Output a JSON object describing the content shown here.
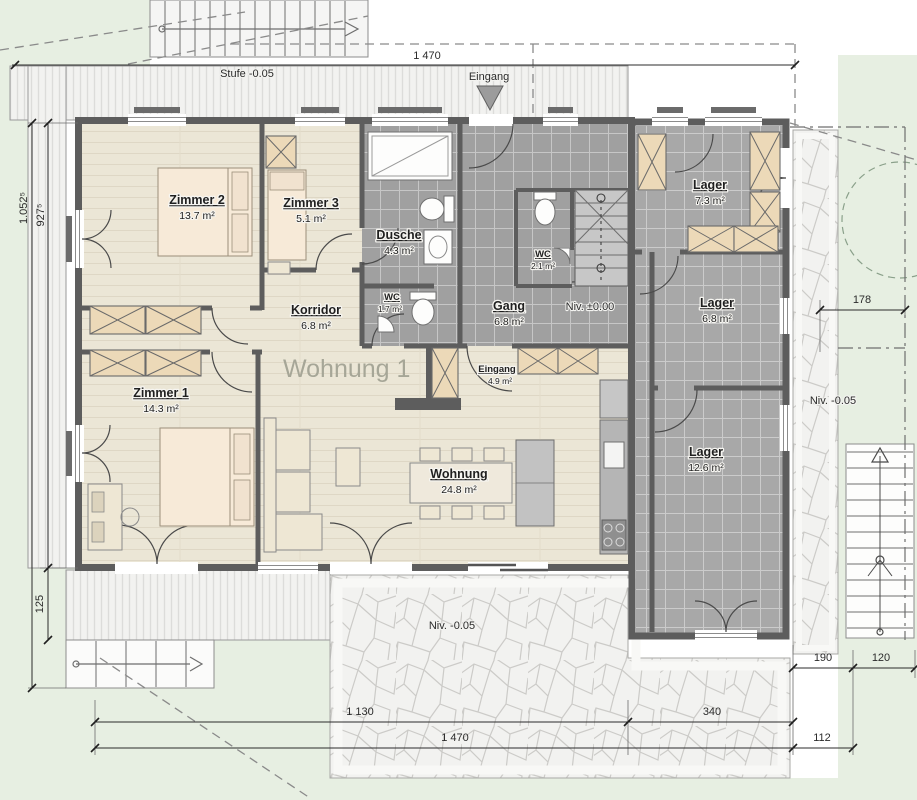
{
  "plan": {
    "big_label": "Wohnung 1",
    "rooms": [
      {
        "name": "Zimmer 2",
        "area": "13.7 m²"
      },
      {
        "name": "Zimmer 3",
        "area": "5.1 m²"
      },
      {
        "name": "Dusche",
        "area": "4.3 m²"
      },
      {
        "name": "WC",
        "area": "1.7 m²"
      },
      {
        "name": "WC",
        "area": "2.1 m²"
      },
      {
        "name": "Gang",
        "area": "6.8 m²"
      },
      {
        "name": "Korridor",
        "area": "6.8 m²"
      },
      {
        "name": "Zimmer 1",
        "area": "14.3 m²"
      },
      {
        "name": "Eingang",
        "area": "4.9 m²"
      },
      {
        "name": "Wohnung",
        "area": "24.8 m²"
      },
      {
        "name": "Lager",
        "area": "7.3 m²"
      },
      {
        "name": "Lager",
        "area": "6.8 m²"
      },
      {
        "name": "Lager",
        "area": "12.6 m²"
      }
    ],
    "annotations": {
      "stufe": "Stufe -0.05",
      "entry_arrow": "Eingang",
      "niv_zero": "Niv. ±0.00",
      "niv_right": "Niv. -0.05",
      "niv_terrace": "Niv. -0.05"
    },
    "dimensions": {
      "top_1470": "1 470",
      "right_178": "178",
      "w_190": "190",
      "w_120": "120",
      "w_1130": "1 130",
      "w_340": "340",
      "b_1470": "1 470",
      "w_112": "112",
      "h_1052": "1.052⁵",
      "h_927": "927⁵",
      "h_125": "125"
    },
    "colors": {
      "wall": "#5d5d5d",
      "wood_floor": "#ebe6d6",
      "tile_floor": "#a0a0a0",
      "furniture": "#ecd9b8",
      "bed": "#f7ead8",
      "lawn": "#e7efe2",
      "stone": "#f2f2f0"
    }
  }
}
